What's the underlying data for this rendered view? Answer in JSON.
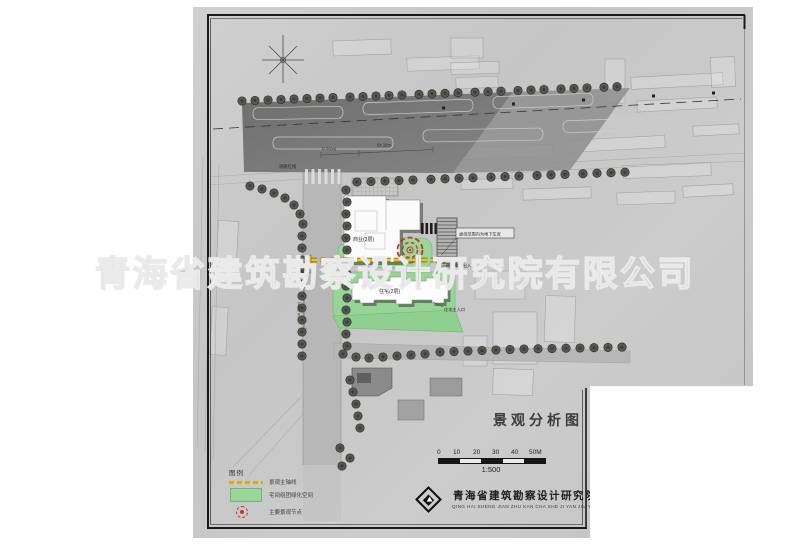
{
  "watermark": {
    "text": "青海省建筑勘察设计研究院有限公司"
  },
  "plan": {
    "labels": {
      "road_redline": "道路红线",
      "dim_width": "12.50(m)",
      "dim_length": "54.10m",
      "dim_road": "16.20(m)",
      "commercial_building": "商业(3层)",
      "residential_building": "住宅(2层)",
      "garage_note": "虚线范围内为地下车库",
      "garage_entrance": "地下车库出入口",
      "residential_entrance": "住宅主入口",
      "site_entrance": "小区主入口"
    }
  },
  "legend": {
    "header": "图例",
    "items": [
      {
        "label": "景观主轴线",
        "swatch": "yellow-dashed-axis"
      },
      {
        "label": "宅间组团绿化空间",
        "swatch": "green-area"
      },
      {
        "label": "主要景观节点",
        "swatch": "red-landscape-node"
      }
    ]
  },
  "title_block": {
    "drawing_title": "景观分析图",
    "scale_ratio": "1:500",
    "scale_ticks": [
      "0",
      "10",
      "20",
      "30",
      "40",
      "50M"
    ],
    "company_name": "青海省建筑勘察设计研究院",
    "company_pinyin": "QING HAI SHENG JIAN ZHU KAN CHA SHE JI YAN JIU YUAN"
  },
  "colors": {
    "sheet_gray": "#c8c8c8",
    "road_dark": "#6d6d6d",
    "green_area": "#9ad69a",
    "axis_yellow": "#f0c419",
    "node_red": "#c4342c",
    "tree_dark": "#50544c"
  }
}
